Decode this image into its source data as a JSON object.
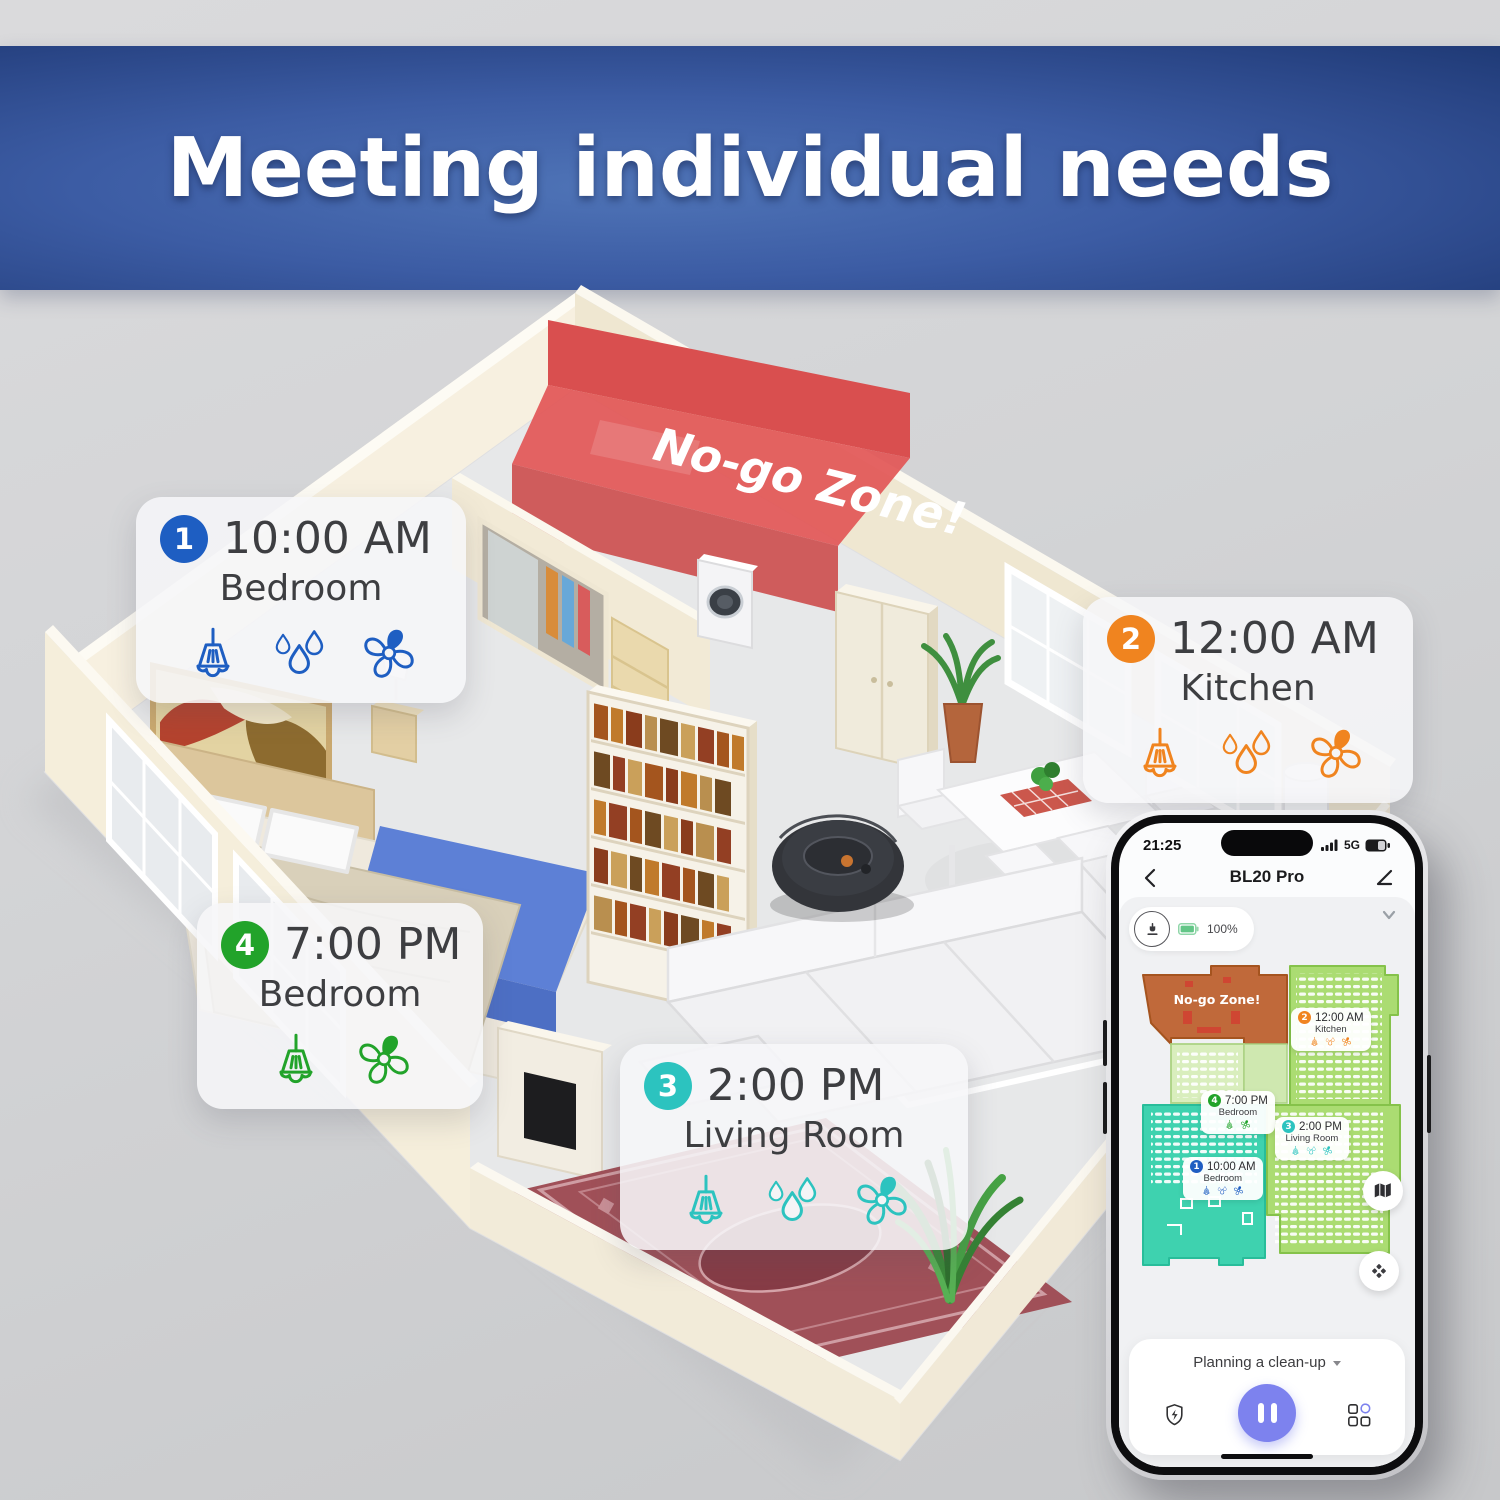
{
  "banner": {
    "title": "Meeting individual needs",
    "bg_color": "#2c4a8c"
  },
  "scene": {
    "no_go_zone_label": "No-go Zone!",
    "callouts": [
      {
        "number": "1",
        "time": "10:00 AM",
        "room": "Bedroom",
        "color": "#1e5ec2",
        "icons": [
          "broom-icon",
          "water-drops-icon",
          "fan-icon"
        ]
      },
      {
        "number": "2",
        "time": "12:00 AM",
        "room": "Kitchen",
        "color": "#f0841f",
        "icons": [
          "broom-icon",
          "water-drops-icon",
          "fan-icon"
        ]
      },
      {
        "number": "3",
        "time": "2:00 PM",
        "room": "Living Room",
        "color": "#2cc3bf",
        "icons": [
          "broom-icon",
          "water-drops-icon",
          "fan-icon"
        ]
      },
      {
        "number": "4",
        "time": "7:00 PM",
        "room": "Bedroom",
        "color": "#22a32a",
        "icons": [
          "broom-icon",
          "fan-icon"
        ]
      }
    ]
  },
  "phone": {
    "status_bar": {
      "time": "21:25",
      "network": "5G"
    },
    "header": {
      "title": "BL20 Pro"
    },
    "robot_status": {
      "battery": "100%"
    },
    "map": {
      "no_go_zone_label": "No-go Zone!",
      "schedule_labels": [
        {
          "number": "1",
          "time": "10:00 AM",
          "room": "Bedroom"
        },
        {
          "number": "2",
          "time": "12:00 AM",
          "room": "Kitchen"
        },
        {
          "number": "3",
          "time": "2:00 PM",
          "room": "Living Room"
        },
        {
          "number": "4",
          "time": "7:00 PM",
          "room": "Bedroom"
        }
      ]
    },
    "footer": {
      "status_label": "Planning a clean-up"
    }
  }
}
